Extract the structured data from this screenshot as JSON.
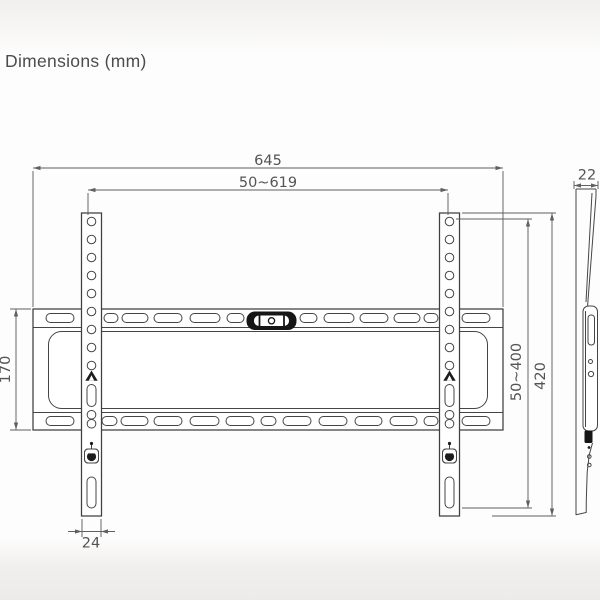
{
  "title": "Dimensions (mm)",
  "dimensions": {
    "overall_width": "645",
    "mount_width_range": "50~619",
    "plate_height": "170",
    "mount_height_range": "50~400",
    "bracket_height": "420",
    "bracket_width": "24",
    "profile_depth": "22"
  },
  "icons": {
    "level": "spirit-level-icon",
    "center_marker": "center-arrow-icon",
    "lock": "safety-lock-icon"
  },
  "colors": {
    "drawing_line": "#3f3f3f",
    "dimension_line": "#606060",
    "label_text": "#545454",
    "level_fill": "#161616",
    "background": "#fdfdfd"
  }
}
